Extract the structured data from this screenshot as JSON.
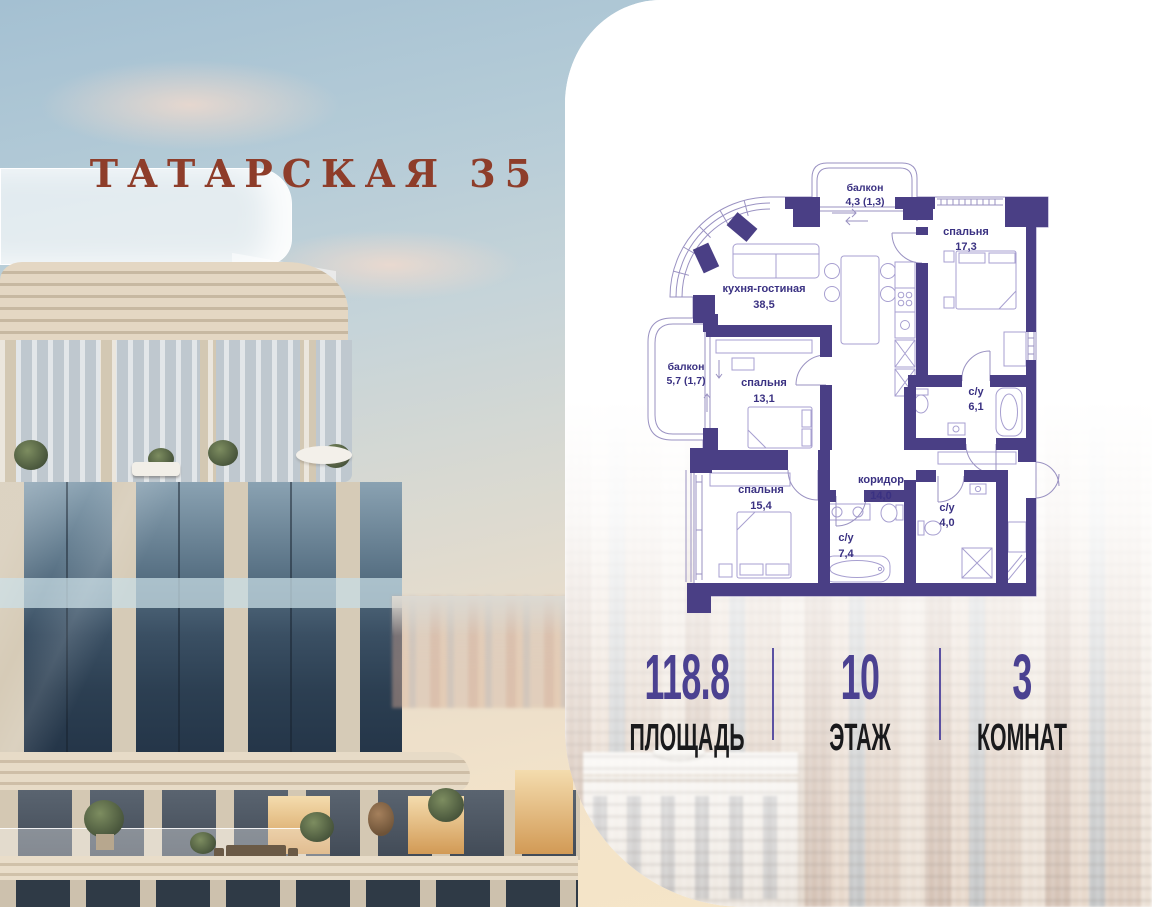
{
  "project": {
    "title": "ТАТАРСКАЯ 35"
  },
  "plan": {
    "rooms": [
      {
        "id": "balcony-top",
        "name": "балкон",
        "area": "4,3 (1,3)"
      },
      {
        "id": "bedroom-17",
        "name": "спальня",
        "area": "17,3"
      },
      {
        "id": "kitchen-living",
        "name": "кухня-гостиная",
        "area": "38,5"
      },
      {
        "id": "balcony-left",
        "name": "балкон",
        "area": "5,7 (1,7)"
      },
      {
        "id": "bedroom-13",
        "name": "спальня",
        "area": "13,1"
      },
      {
        "id": "bathroom-6",
        "name": "с/у",
        "area": "6,1"
      },
      {
        "id": "corridor",
        "name": "коридор",
        "area": "14,0"
      },
      {
        "id": "bedroom-15",
        "name": "спальня",
        "area": "15,4"
      },
      {
        "id": "bathroom-7",
        "name": "с/у",
        "area": "7,4"
      },
      {
        "id": "bathroom-4",
        "name": "с/у",
        "area": "4,0"
      }
    ]
  },
  "stats": [
    {
      "value": "118.8",
      "label": "ПЛОЩАДЬ"
    },
    {
      "value": "10",
      "label": "ЭТАЖ"
    },
    {
      "value": "3",
      "label": "КОМНАТ"
    }
  ],
  "colors": {
    "wall": "#4a3f85",
    "plan_line": "#9a92c2",
    "plan_label": "#3a3182",
    "accent_number": "#4b4191",
    "divider": "#5b50a2",
    "title": "#8e3d2a"
  }
}
